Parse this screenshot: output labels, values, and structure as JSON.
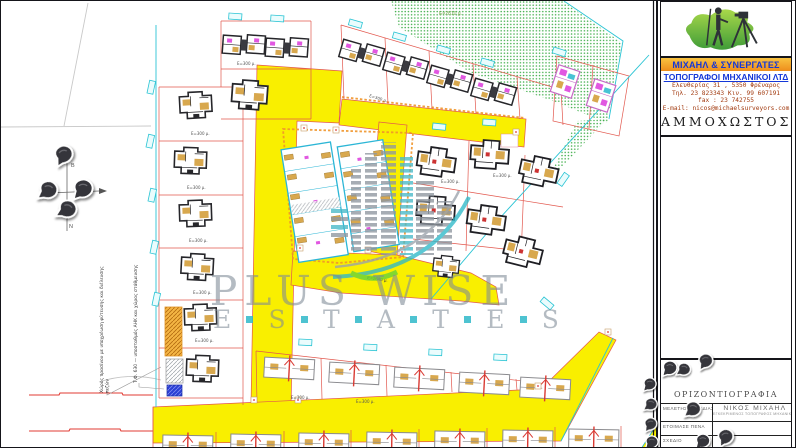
{
  "panel": {
    "firm_name": "ΜΙΧΑΗΛ & ΣΥΝΕΡΓΑΤΕΣ",
    "firm_type": "ΤΟΠΟΓΡΑΦΟΙ ΜΗΧΑΝΙΚΟΙ ΛΤΔ",
    "address_line": "Ελευθερίας 31 ,  5350 Φρέναρος",
    "phone_line": "Τηλ. 23 823343   Κιν. 99 607191",
    "fax_line": "fax : 23 742755",
    "email_line": "E-mail: nicos@michaelsurveyors.com",
    "city": "ΑΜΜΟΧΩΣΤΟΣ",
    "drawing_title": "ΟΡΙΖΟΝΤΙΟΓΡΑΦΙΑ",
    "table_rows": [
      {
        "label": "ΜΕΛΕΤΗΣΕ-ΣΧΕΔΙΑΣΕ",
        "value": "ΝΙΚΟΣ ΜΙΧΑΗΛ",
        "sub": "ΕΓΚΕΚΡΙΜΕΝΟΣ ΤΟΠΟΓΡΑΦΟΣ ΜΗΧΑΝΙΚΟΣ"
      },
      {
        "label": "ΕΤΟΙΜΑΣΕ ΠΕΝΑ",
        "value": "",
        "sub": ""
      },
      {
        "label": "ΣΧΕΔΙΟ",
        "value": "",
        "sub": ""
      }
    ]
  },
  "map": {
    "green_area_label": "Ε=2810 μ.",
    "road_area_label": "Ε=2640 μ.",
    "plot_area_label": "Ε=300 μ.",
    "compass": {
      "north": "Β",
      "south": "Ν",
      "west": "Δ"
    },
    "side_note_1": "Χώρος πρασίνου με υποχρέωση φύτευσης και διέλευσης πεζών",
    "side_note_2": "Τ.Φ. 630 — υποσταθμός ΑΗΚ και χώρος στάθμευσης"
  },
  "watermark": {
    "line1": "PLUS WISE",
    "line2_letters": [
      "E",
      "S",
      "T",
      "A",
      "T",
      "E",
      "S"
    ],
    "accent_color": "#2fb9c9",
    "text_color": "#8b97a3"
  },
  "colors": {
    "road_yellow": "#f9ef00",
    "plot_line_red": "#e2574d",
    "vegetation_green": "#3fae4a",
    "label_cyan": "#2bc4d4",
    "accent_orange": "#f09d2e"
  }
}
